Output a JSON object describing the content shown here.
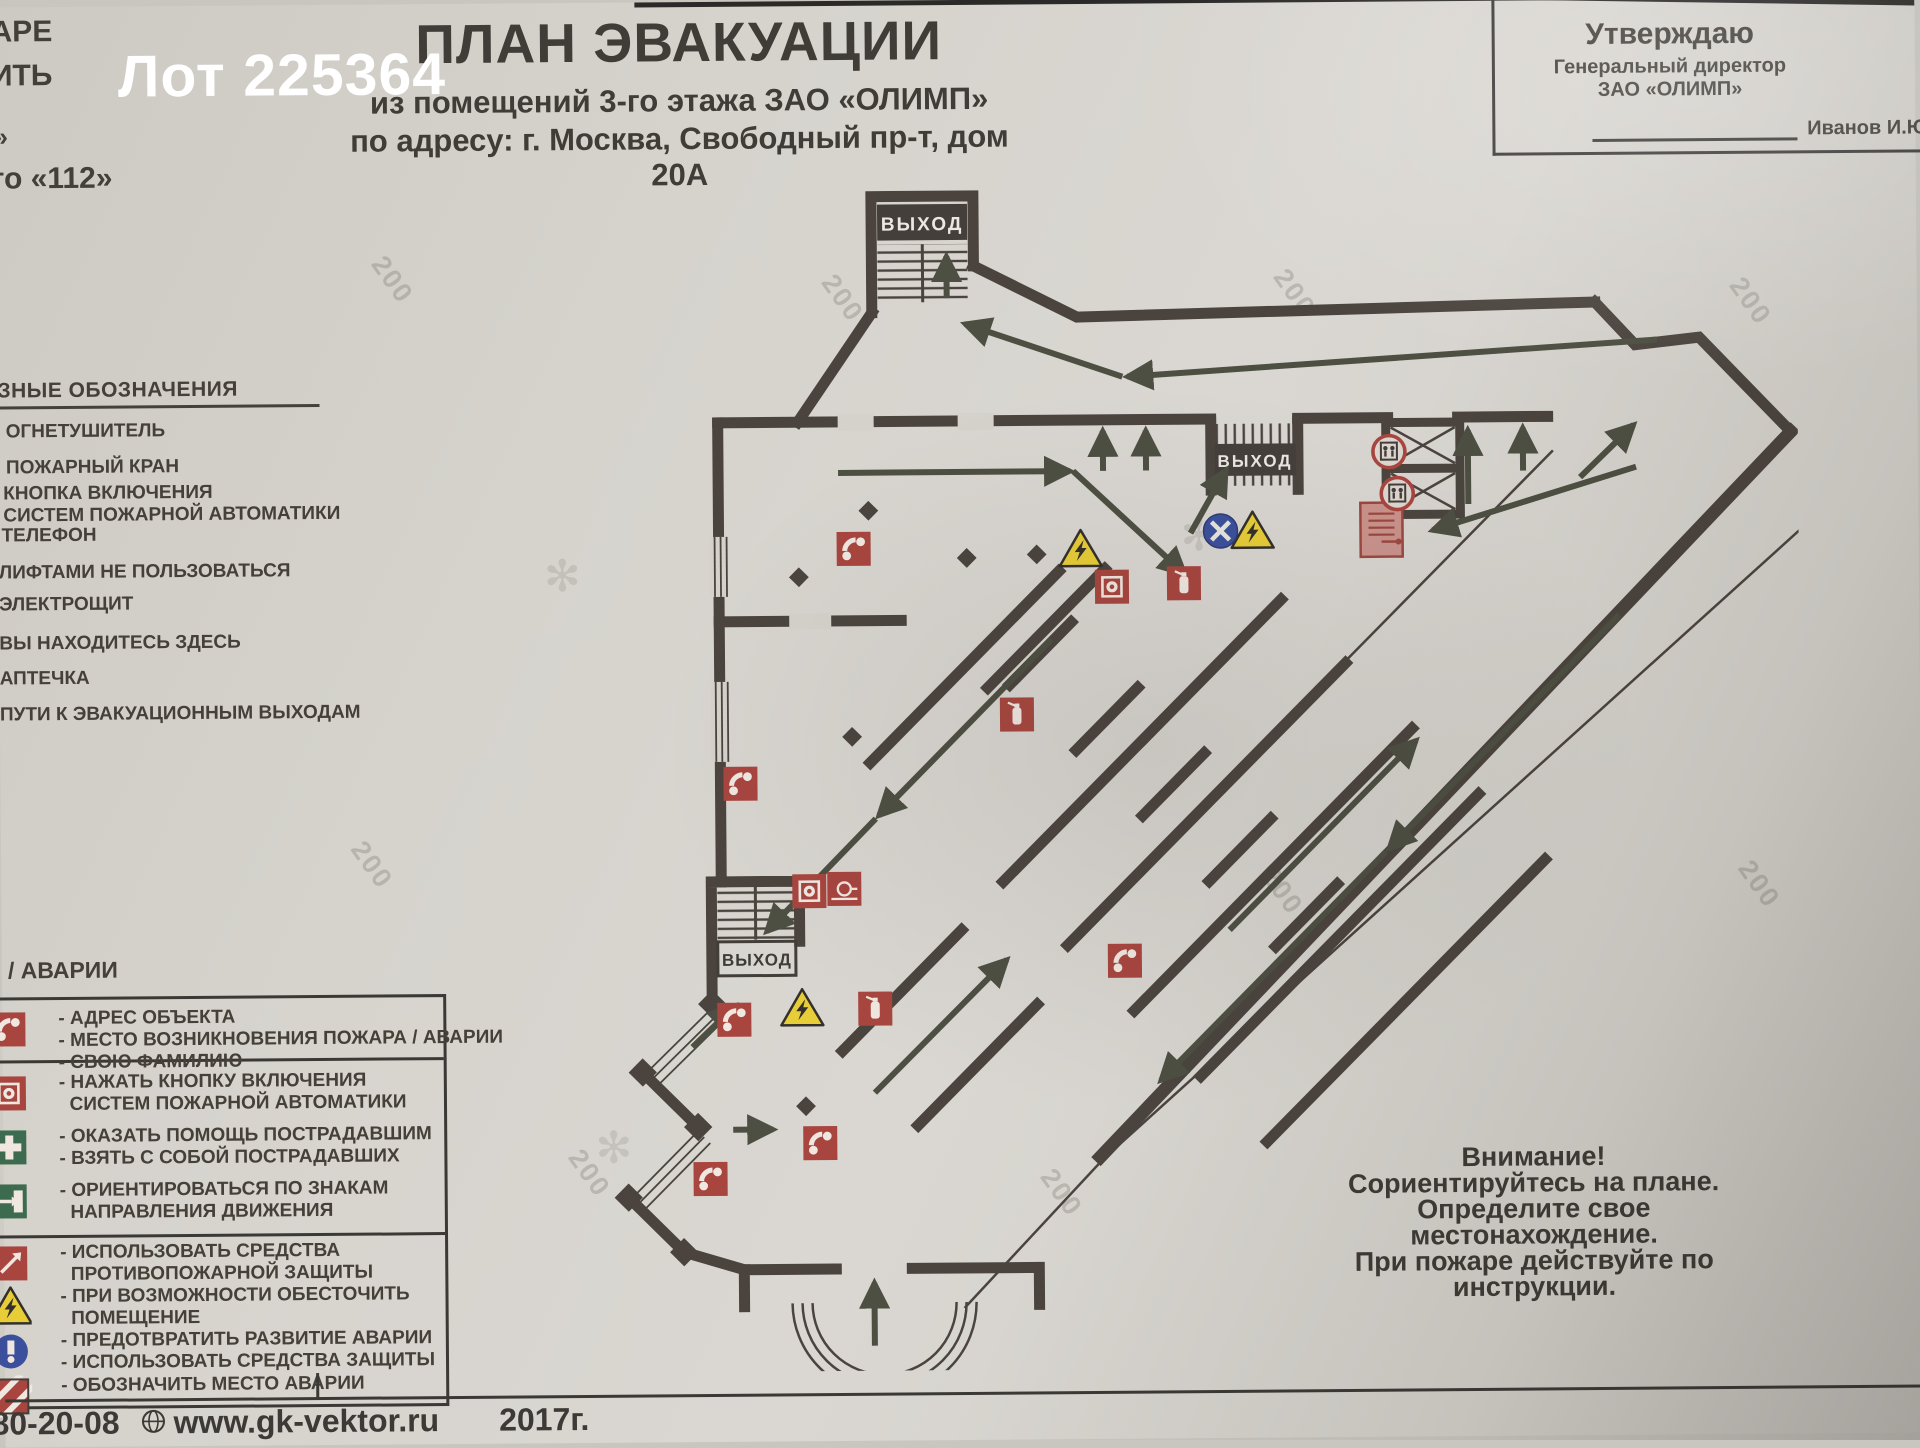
{
  "overlay": {
    "lot_label": "Лот 225364"
  },
  "corner_fragments": [
    {
      "text": "АРЕ",
      "x": -4,
      "y": 8,
      "size": 30
    },
    {
      "text": "ИТЬ",
      "x": -4,
      "y": 52,
      "size": 30
    },
    {
      "text": "»",
      "x": -2,
      "y": 114,
      "size": 26
    },
    {
      "text": "то «112»",
      "x": -6,
      "y": 155,
      "size": 30
    }
  ],
  "header": {
    "title": "ПЛАН ЭВАКУАЦИИ",
    "subtitle1": "из помещений 3-го этажа ЗАО «ОЛИМП»",
    "subtitle2": "по адресу: г. Москва, Свободный пр-т, дом 20А"
  },
  "approval": {
    "line1": "Утверждаю",
    "line2": "Генеральный директор",
    "line3": "ЗАО «ОЛИМП»",
    "signature_name": "Иванов И.Ю"
  },
  "legend": {
    "heading": "ЗНЫЕ ОБОЗНАЧЕНИЯ",
    "items": [
      {
        "x": 8,
        "y": 414,
        "lines": [
          "ОГНЕТУШИТЕЛЬ"
        ]
      },
      {
        "x": 8,
        "y": 450,
        "lines": [
          "ПОЖАРНЫЙ КРАН"
        ]
      },
      {
        "x": 5,
        "y": 476,
        "lines": [
          "КНОПКА ВКЛЮЧЕНИЯ",
          "СИСТЕМ ПОЖАРНОЙ АВТОМАТИКИ"
        ]
      },
      {
        "x": 3,
        "y": 518,
        "lines": [
          "ТЕЛЕФОН"
        ]
      },
      {
        "x": 0,
        "y": 555,
        "lines": [
          "ЛИФТАМИ НЕ ПОЛЬЗОВАТЬСЯ"
        ]
      },
      {
        "x": 0,
        "y": 587,
        "lines": [
          "ЭЛЕКТРОЩИТ"
        ]
      },
      {
        "x": 0,
        "y": 626,
        "lines": [
          "ВЫ НАХОДИТЕСЬ ЗДЕСЬ"
        ]
      },
      {
        "x": 0,
        "y": 661,
        "lines": [
          "АПТЕЧКА"
        ]
      },
      {
        "x": 0,
        "y": 697,
        "lines": [
          "ПУТИ К ЭВАКУАЦИОННЫМ ВЫХОДАМ"
        ]
      }
    ]
  },
  "instructions": {
    "heading": "/ АВАРИИ",
    "dividers_rel_y": [
      60,
      235
    ],
    "groups": [
      {
        "icon": "phone",
        "rel_y": 8,
        "lines": [
          "- АДРЕС ОБЪЕКТА",
          "- МЕСТО ВОЗНИКНОВЕНИЯ ПОЖАРА / АВАРИИ",
          "- СВОЮ ФАМИЛИЮ"
        ]
      },
      {
        "icon": "fire-button",
        "rel_y": 72,
        "lines": [
          "- НАЖАТЬ КНОПКУ ВКЛЮЧЕНИЯ",
          "  СИСТЕМ ПОЖАРНОЙ АВТОМАТИКИ"
        ]
      },
      {
        "icon": "medkit",
        "rel_y": 126,
        "lines": [
          "- ОКАЗАТЬ ПОМОЩЬ ПОСТРАДАВШИМ",
          "- ВЗЯТЬ С СОБОЙ ПОСТРАДАВШИХ"
        ]
      },
      {
        "icon": "exit-sign",
        "rel_y": 180,
        "lines": [
          "- ОРИЕНТИРОВАТЬСЯ ПО ЗНАКАМ",
          "  НАПРАВЛЕНИЯ ДВИЖЕНИЯ"
        ]
      },
      {
        "icon": "fire-equip",
        "rel_y": 242,
        "lines": [
          "- ИСПОЛЬЗОВАТЬ СРЕДСТВА",
          "  ПРОТИВОПОЖАРНОЙ ЗАЩИТЫ"
        ]
      },
      {
        "icon": "warn",
        "rel_y": 286,
        "lines": [
          "- ПРИ ВОЗМОЖНОСТИ ОБЕСТОЧИТЬ",
          "  ПОМЕЩЕНИЕ"
        ]
      },
      {
        "icon": "prevent",
        "rel_y": 330,
        "lines": [
          "- ПРЕДОТВРАТИТЬ РАЗВИТИЕ АВАРИИ",
          "- ИСПОЛЬЗОВАТЬ СРЕДСТВА ЗАЩИТЫ"
        ]
      },
      {
        "icon": "stripes",
        "rel_y": 375,
        "lines": [
          "- ОБОЗНАЧИТЬ МЕСТО АВАРИИ"
        ]
      }
    ]
  },
  "attention": {
    "lines": [
      "Внимание!",
      "Сориентируйтесь на плане.",
      "Определите свое местонахождение.",
      "При пожаре действуйте по инструкции."
    ]
  },
  "footer": {
    "phone_fragment": "80-20-08",
    "website": "www.gk-vektor.ru",
    "year": "2017г."
  },
  "plan": {
    "exit_label": "ВЫХОД",
    "icons": [
      {
        "type": "phone",
        "x": 315,
        "y": 408
      },
      {
        "type": "phone",
        "x": 200,
        "y": 642
      },
      {
        "type": "phone",
        "x": 192,
        "y": 878
      },
      {
        "type": "phone",
        "x": 277,
        "y": 1002
      },
      {
        "type": "phone",
        "x": 167,
        "y": 1037
      },
      {
        "type": "phone",
        "x": 583,
        "y": 822
      },
      {
        "type": "ext",
        "x": 477,
        "y": 575
      },
      {
        "type": "ext",
        "x": 645,
        "y": 445
      },
      {
        "type": "ext",
        "x": 333,
        "y": 868
      },
      {
        "type": "fire-button",
        "x": 573,
        "y": 448
      },
      {
        "type": "fire-button",
        "x": 268,
        "y": 750
      },
      {
        "type": "hose",
        "x": 303,
        "y": 748
      },
      {
        "type": "hosecab",
        "x": 843,
        "y": 393
      },
      {
        "type": "warn",
        "x": 542,
        "y": 411
      },
      {
        "type": "warn",
        "x": 714,
        "y": 394
      },
      {
        "type": "warn",
        "x": 260,
        "y": 868
      },
      {
        "type": "here",
        "x": 682,
        "y": 393
      },
      {
        "type": "nolift",
        "x": 851,
        "y": 315
      },
      {
        "type": "nolift",
        "x": 859,
        "y": 357
      },
      {
        "type": "diamond",
        "x": 260,
        "y": 436
      },
      {
        "type": "diamond",
        "x": 330,
        "y": 370
      },
      {
        "type": "diamond",
        "x": 428,
        "y": 418
      },
      {
        "type": "diamond",
        "x": 498,
        "y": 415
      },
      {
        "type": "diamond",
        "x": 312,
        "y": 596
      },
      {
        "type": "diamond",
        "x": 263,
        "y": 965
      }
    ],
    "watermark_text": "200",
    "watermark_positions": [
      {
        "x": 370,
        "y": 260
      },
      {
        "x": 820,
        "y": 282
      },
      {
        "x": 1272,
        "y": 280
      },
      {
        "x": 1728,
        "y": 292
      },
      {
        "x": 345,
        "y": 845
      },
      {
        "x": 1255,
        "y": 878
      },
      {
        "x": 1732,
        "y": 875
      },
      {
        "x": 560,
        "y": 1155
      },
      {
        "x": 1032,
        "y": 1178
      }
    ],
    "swirl_positions": [
      {
        "x": 545,
        "y": 548
      },
      {
        "x": 592,
        "y": 1120
      },
      {
        "x": 1182,
        "y": 512
      }
    ]
  },
  "colors": {
    "paper": "#d5d1cb",
    "wall": "#4b443e",
    "arrow": "#4d4f42",
    "red_icon": "#a8453f",
    "light_red": "#c9928b",
    "yellow": "#e7cd37",
    "blue": "#3b4f9c",
    "green": "#3d6b4f",
    "dark_text": "#454038"
  }
}
